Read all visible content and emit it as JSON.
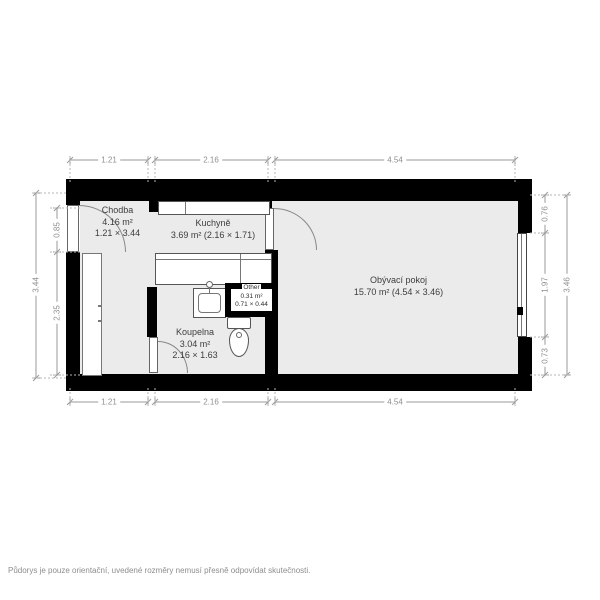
{
  "rooms": {
    "chodba": {
      "name": "Chodba",
      "area": "4.16 m²",
      "dims": "1.21 × 3.44"
    },
    "kuchyne": {
      "name": "Kuchyně",
      "area": "3.69 m² (2.16 × 1.71)"
    },
    "obyvaci": {
      "name": "Obývací pokoj",
      "area": "15.70 m² (4.54 × 3.46)"
    },
    "koupelna": {
      "name": "Koupelna",
      "area": "3.04 m²",
      "dims": "2.16 × 1.63"
    },
    "other": {
      "name": "Other",
      "area": "0.31 m²",
      "dims": "0.71 × 0.44"
    }
  },
  "dimensions": {
    "top": [
      "1.21",
      "2.16",
      "4.54"
    ],
    "bottom": [
      "1.21",
      "2.16",
      "4.54"
    ],
    "left_inner": [
      "0.85",
      "2.35"
    ],
    "left_outer": "3.44",
    "right_inner": [
      "0.76",
      "1.97",
      "0.73"
    ],
    "right_outer": "3.46"
  },
  "footer": {
    "disclaimer": "Půdorys je pouze orientační, uvedené rozměry nemusí přesně odpovídat skutečnosti."
  },
  "colors": {
    "wall": "#000000",
    "floor": "#ebebeb",
    "dim_text": "#8f8f8f",
    "label_text": "#3d3d3d"
  }
}
